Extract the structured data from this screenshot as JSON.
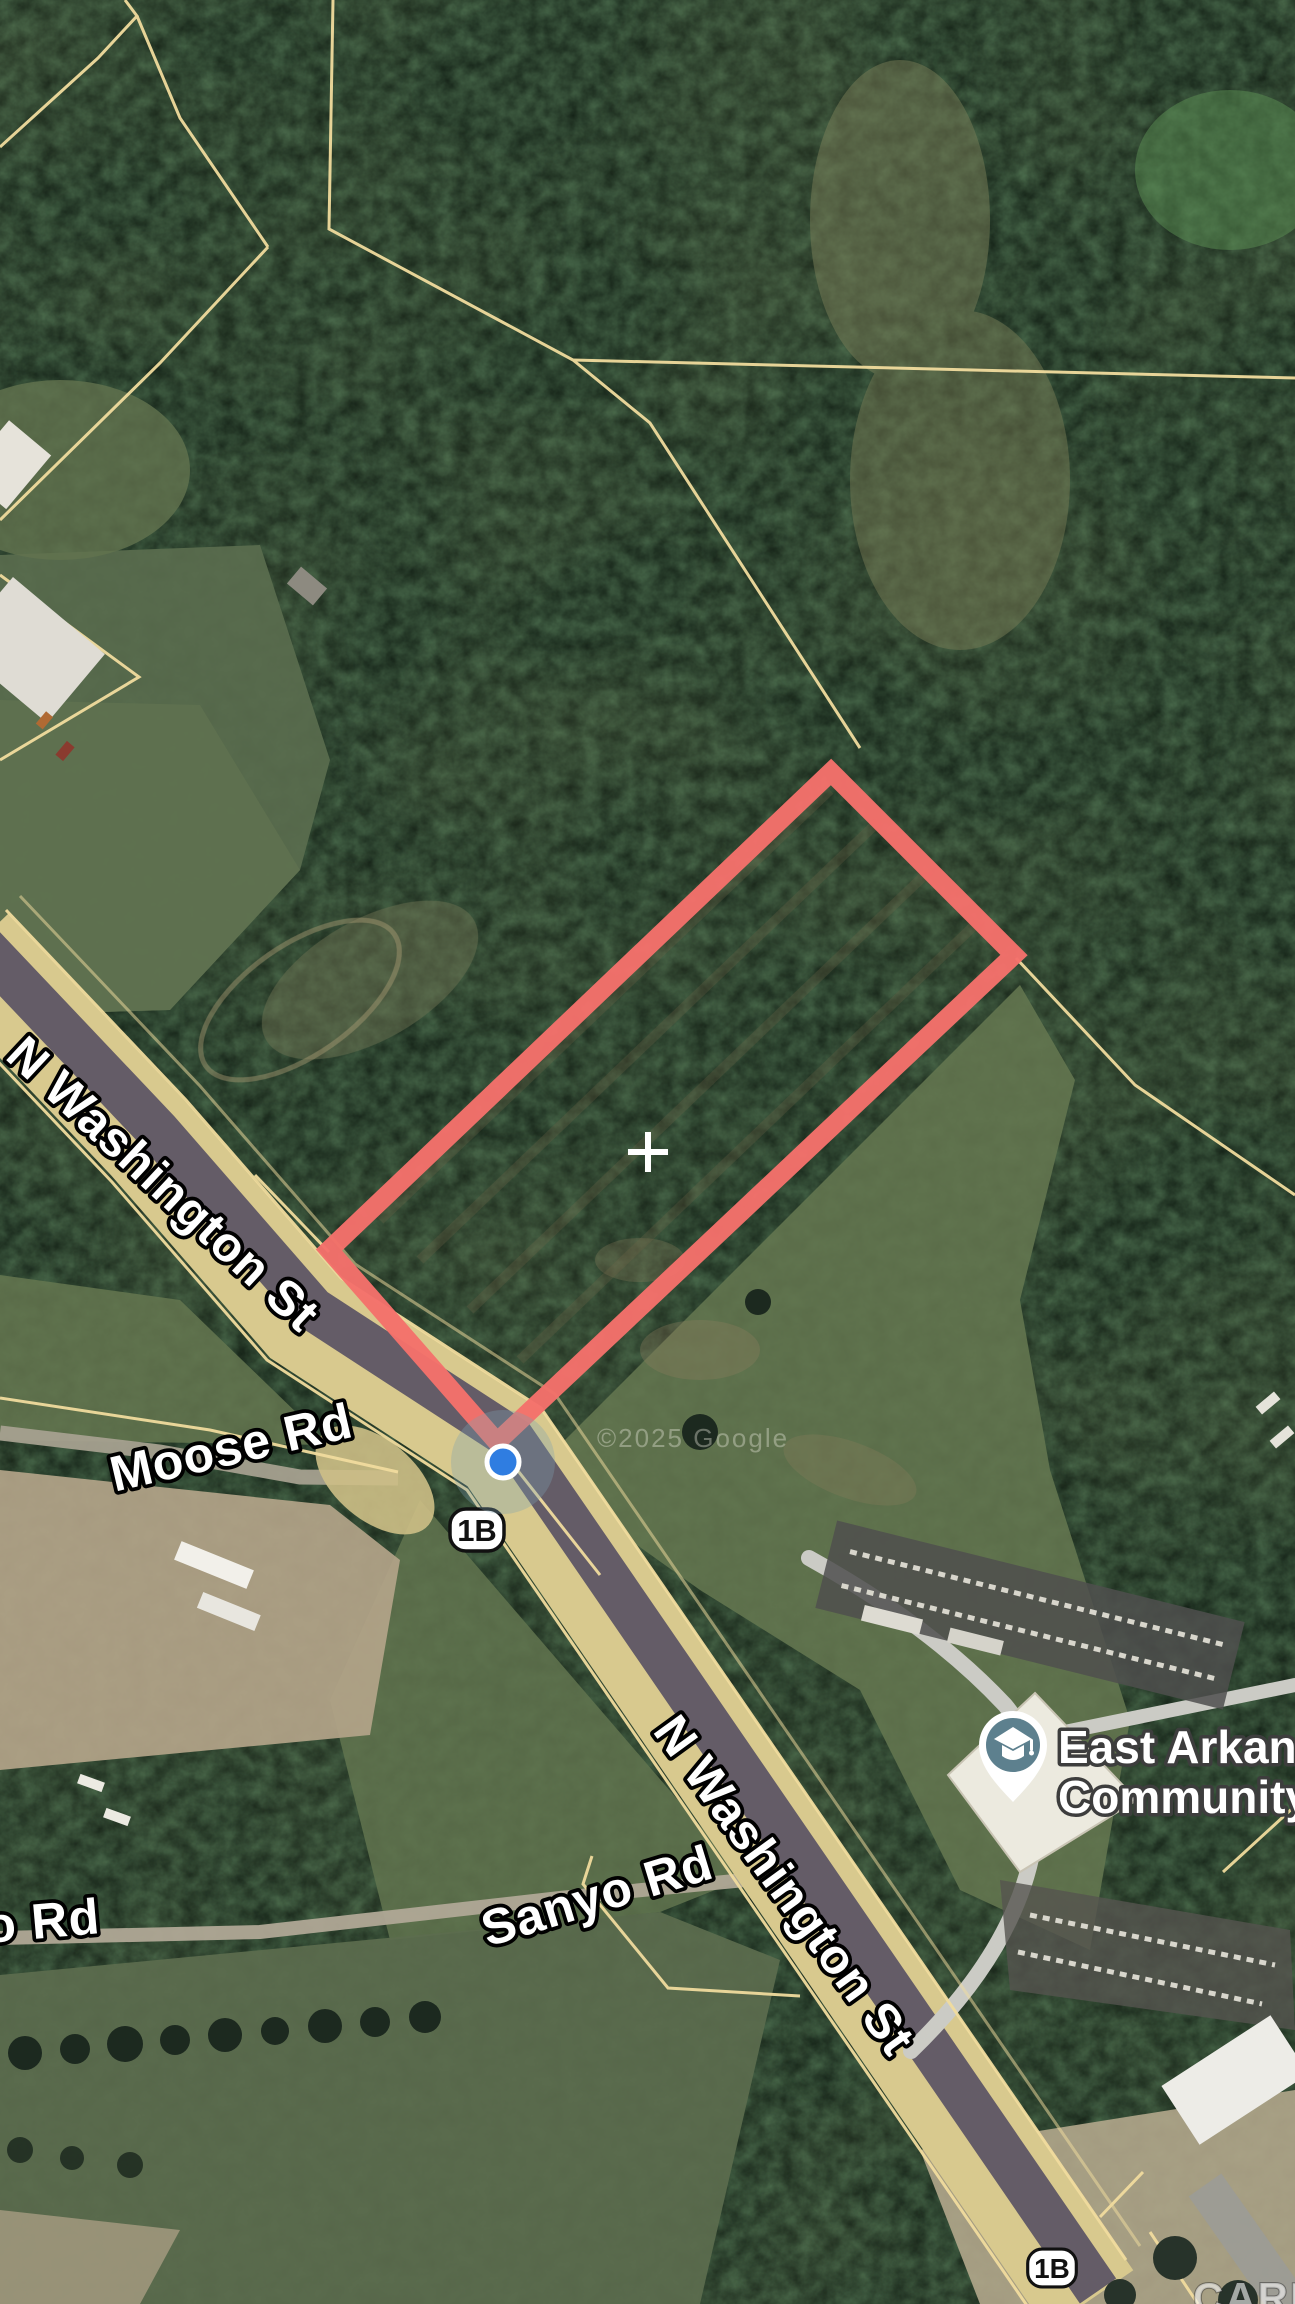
{
  "map": {
    "view_type": "satellite",
    "attribution": "©2025 Google",
    "watermark": "CARMLS, INC",
    "roads": {
      "n_washington_upper": "N Washington St",
      "n_washington_lower": "N Washington St",
      "moose": "Moose Rd",
      "sanyo": "Sanyo Rd",
      "sanyo_clipped": "o Rd",
      "route_shield": "1B"
    },
    "poi": {
      "name_line1": "East Arkans",
      "name_line2": "Community",
      "icon": "graduation-cap-icon"
    },
    "marker": {
      "type": "current-location-dot"
    },
    "overlay": {
      "highlight": "property-parcel-outline",
      "crosshair": "parcel-center-cross"
    },
    "colors": {
      "parcel_highlight": "#f4716b",
      "parcel_boundary_lines": "#f1dc9e",
      "location_dot": "#2f7de1",
      "highway_surface": "#d8c98e",
      "asphalt": "#5a5264",
      "poi_pin": "#5d808e"
    }
  }
}
